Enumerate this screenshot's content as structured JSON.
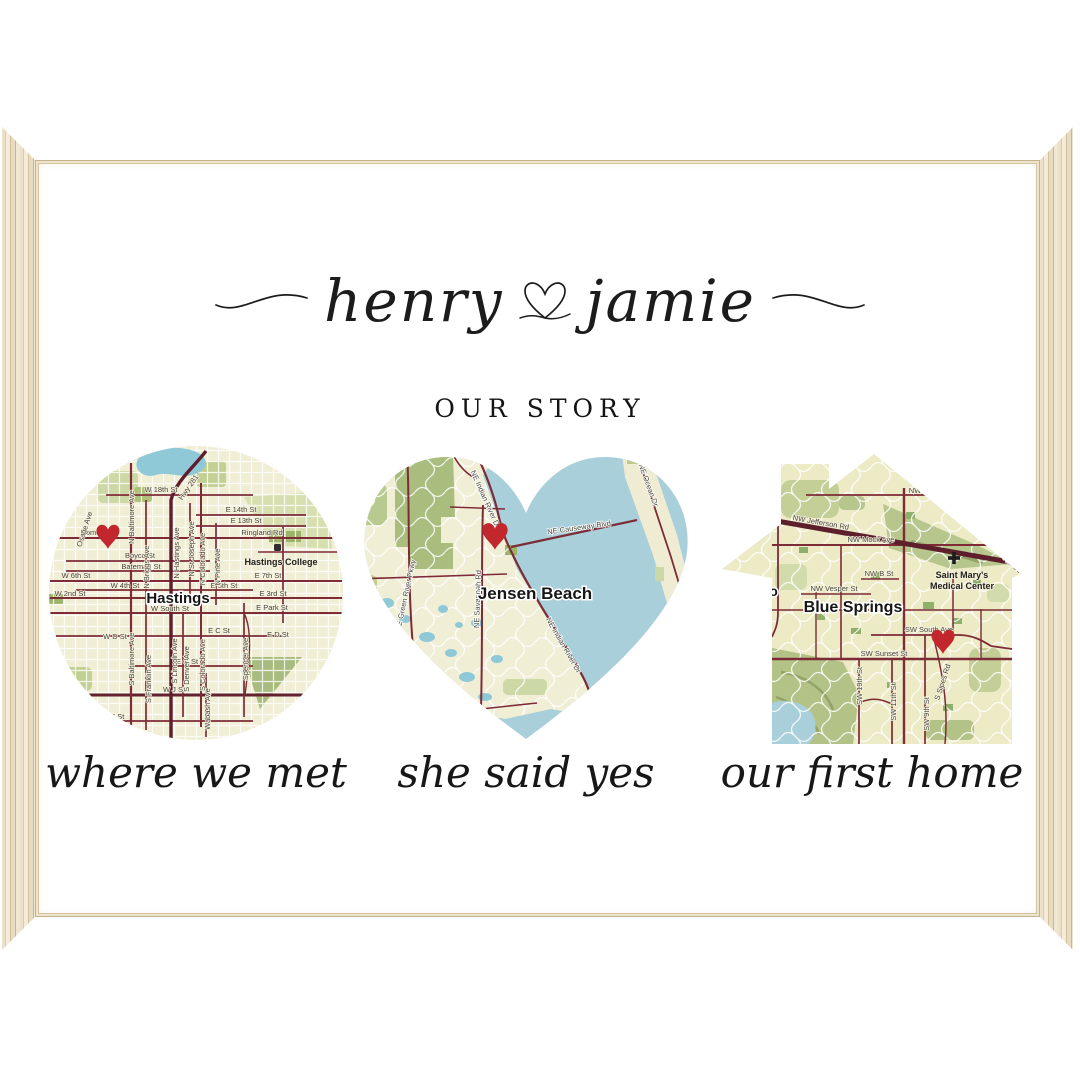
{
  "header": {
    "name_left": "henry",
    "name_right": "jamie",
    "subtitle": "OUR STORY"
  },
  "colors": {
    "frame_wood": "#e9dec5",
    "land": "#f1eed6",
    "water": "#a9cfda",
    "green": "#b5c687",
    "road": "#7d2b36",
    "road_major": "#5d1f2b",
    "heart_marker": "#c1272d",
    "text": "#1c1c1c"
  },
  "maps": [
    {
      "shape": "circle",
      "caption": "where we met",
      "city": "Hastings",
      "poi": "Hastings College",
      "streets": {
        "w18": "W 18th St",
        "e14": "E 14th St",
        "e13": "E 13th St",
        "ringland": "Ringland Rd",
        "home": "Home St",
        "boyce": "Boyce St",
        "bateman": "Bateman St",
        "w6": "W 6th St",
        "w4": "W 4th St",
        "w2": "W 2nd St",
        "e7": "E 7th St",
        "e5": "E 5th St",
        "e3": "E 3rd St",
        "wsouth": "W South St",
        "epark": "E Park St",
        "wd": "W D St",
        "ec": "E C St",
        "ed": "E D St",
        "eg": "E G St",
        "wj": "W J St",
        "wm": "W M St",
        "nbalt": "N Baltimore Ave",
        "nbriggs": "N Briggs Ave",
        "nhast": "N Hastings Ave",
        "nstj": "N St Joseph Ave",
        "ncol": "N Colorado Ave",
        "npine": "N Pine Ave",
        "sbalt": "S Baltimore Ave",
        "sfrank": "S Franklin Ave",
        "slinc": "S Lincoln Ave",
        "sden": "S Denver Ave",
        "scol": "S Colorado Ave",
        "spencer": "Spencer Ave",
        "wabash": "Wabash Ave",
        "hwy": "Hwy 281",
        "osage": "Osage Ave"
      }
    },
    {
      "shape": "heart",
      "caption": "she said yes",
      "city": "Jensen Beach",
      "streets": {
        "indr": "NE Indian River Dr",
        "causeway": "NE Causeway Blvd",
        "ocean": "NE Ocean Dr",
        "savannah": "NE Savannah Rd",
        "greenriver": "SE Green River Pkwy"
      }
    },
    {
      "shape": "house",
      "caption": "our first home",
      "city": "Blue Springs",
      "city_partial": "ugo",
      "poi_line1": "Saint Mary's",
      "poi_line2": "Medical Center",
      "streets": {
        "duncan": "NW Duncan",
        "jefferson": "NW Jefferson Rd",
        "mock": "NW Mock Ave",
        "nwb": "NW B St",
        "vesper": "NW Vesper St",
        "south": "SW South Ave",
        "sunset": "SW Sunset St",
        "s19": "SW 19th St",
        "s11": "SW 11th St",
        "s9": "SW 9th St",
        "sipes": "S Sipes Rd",
        "neco": "NE Co"
      }
    }
  ]
}
